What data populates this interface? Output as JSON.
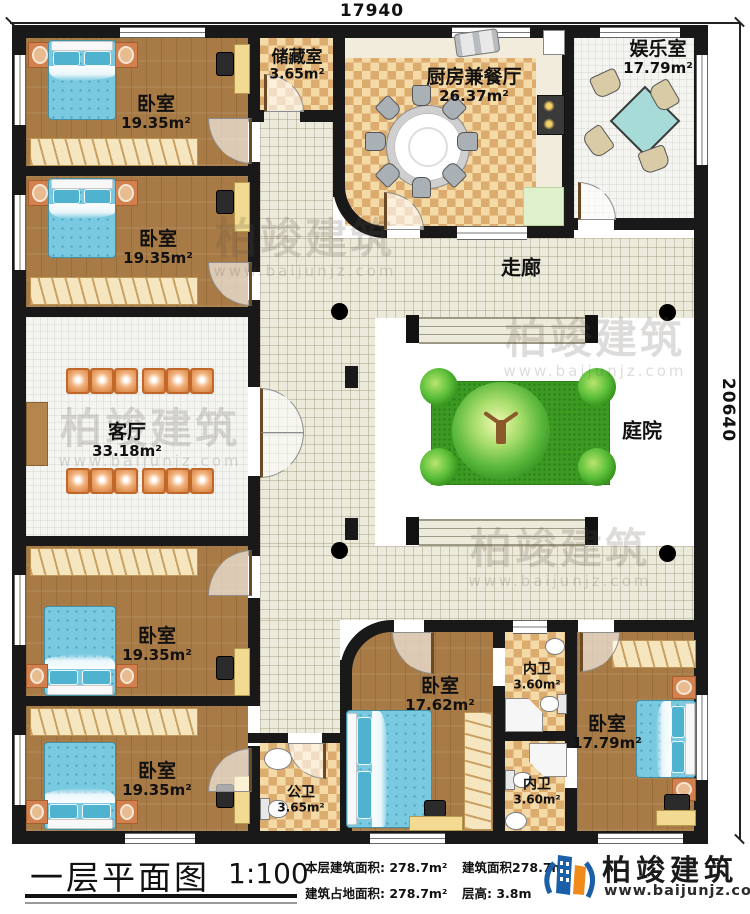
{
  "dimensions": {
    "top": "17940",
    "right": "20640"
  },
  "rooms": [
    {
      "name": "卧室",
      "area": "19.35m²"
    },
    {
      "name": "卧室",
      "area": "19.35m²"
    },
    {
      "name": "储藏室",
      "area": "3.65m²"
    },
    {
      "name": "厨房兼餐厅",
      "area": "26.37m²"
    },
    {
      "name": "娱乐室",
      "area": "17.79m²"
    },
    {
      "name": "走廊",
      "area": ""
    },
    {
      "name": "客厅",
      "area": "33.18m²"
    },
    {
      "name": "庭院",
      "area": ""
    },
    {
      "name": "卧室",
      "area": "19.35m²"
    },
    {
      "name": "卧室",
      "area": "19.35m²"
    },
    {
      "name": "公卫",
      "area": "3.65m²"
    },
    {
      "name": "卧室",
      "area": "17.62m²"
    },
    {
      "name": "内卫",
      "area": "3.60m²"
    },
    {
      "name": "内卫",
      "area": "3.60m²"
    },
    {
      "name": "卧室",
      "area": "17.79m²"
    }
  ],
  "titlebar": {
    "title": "一层平面图",
    "scale": "1:100",
    "stats": [
      {
        "label": "本层建筑面积:",
        "value": "278.7m²"
      },
      {
        "label": "建筑占地面积:",
        "value": "278.7m²"
      },
      {
        "label": "建筑面积",
        "value": "278.7m²"
      },
      {
        "label": "层高:",
        "value": "3.8m"
      }
    ],
    "brand": {
      "name": "柏竣建筑",
      "url": "www.baijunjz.com"
    }
  },
  "watermark": {
    "text": "柏竣建筑",
    "url": "www.baijunjz.com"
  }
}
